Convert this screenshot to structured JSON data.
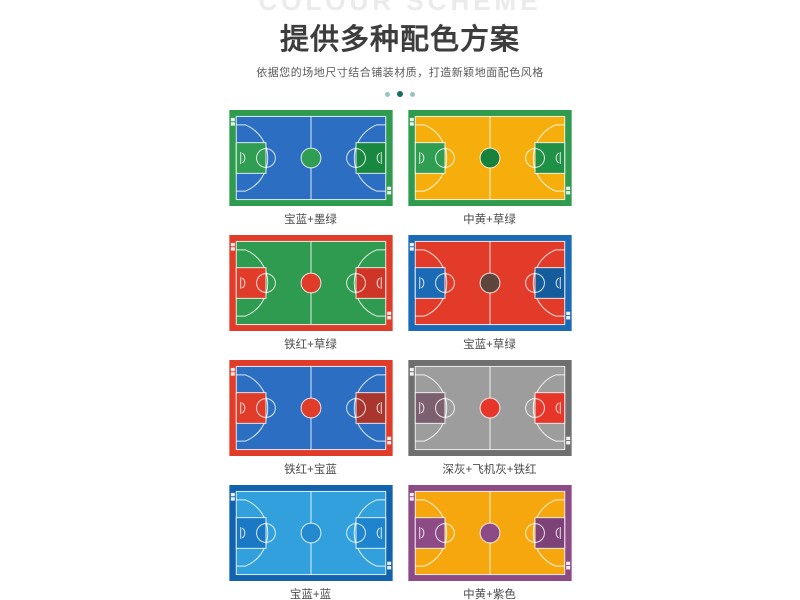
{
  "header": {
    "ghost_text": "COLOUR SCHEME",
    "title": "提供多种配色方案",
    "subtitle": "依据您的场地尺寸结合铺装材质，打造新颖地面配色风格"
  },
  "style": {
    "ghost_color": "#ebebeb",
    "title_color": "#3d3d3d",
    "subtitle_color": "#5a5a5a",
    "label_color": "#4c4c4c",
    "dot_light": "#9bc4bf",
    "dot_dark": "#1d6b62",
    "court_line_color": "#ffffff",
    "badge_color": "#ffffff"
  },
  "courts": [
    {
      "label": "宝蓝+墨绿",
      "colors": {
        "border": "#2e9b4f",
        "court": "#2b6ec2",
        "key_left": "#2f9e52",
        "key_right": "#18873f",
        "center": "#2f9e52"
      }
    },
    {
      "label": "中黄+草绿",
      "colors": {
        "border": "#2e9b4f",
        "court": "#f6ae0c",
        "key_left": "#2f9e52",
        "key_right": "#1f9046",
        "center": "#17823c"
      }
    },
    {
      "label": "铁红+草绿",
      "colors": {
        "border": "#e13b2a",
        "court": "#2f9b50",
        "key_left": "#e13b2a",
        "key_right": "#cf3526",
        "center": "#e13b2a"
      }
    },
    {
      "label": "宝蓝+草绿",
      "colors": {
        "border": "#1b6ab5",
        "court": "#e33b2a",
        "key_left": "#1b6ab5",
        "key_right": "#155c9c",
        "center": "#5e453c"
      }
    },
    {
      "label": "铁红+宝蓝",
      "colors": {
        "border": "#e13b2a",
        "court": "#2b6ec2",
        "key_left": "#e13b2a",
        "key_right": "#a8352e",
        "center": "#e13b2a"
      }
    },
    {
      "label": "深灰+飞机灰+铁红",
      "colors": {
        "border": "#6f6f6f",
        "court": "#9d9d9d",
        "key_left": "#7c6070",
        "key_right": "#e8352a",
        "center": "#e8352a"
      }
    },
    {
      "label": "宝蓝+蓝",
      "colors": {
        "border": "#1263af",
        "court": "#31a0dd",
        "key_left": "#1a78c5",
        "key_right": "#1e84cd",
        "center": "#2489cf"
      }
    },
    {
      "label": "中黄+紫色",
      "colors": {
        "border": "#8d4b86",
        "court": "#f6a70d",
        "key_left": "#8d4b86",
        "key_right": "#7d4278",
        "center": "#8d4b86"
      }
    }
  ]
}
